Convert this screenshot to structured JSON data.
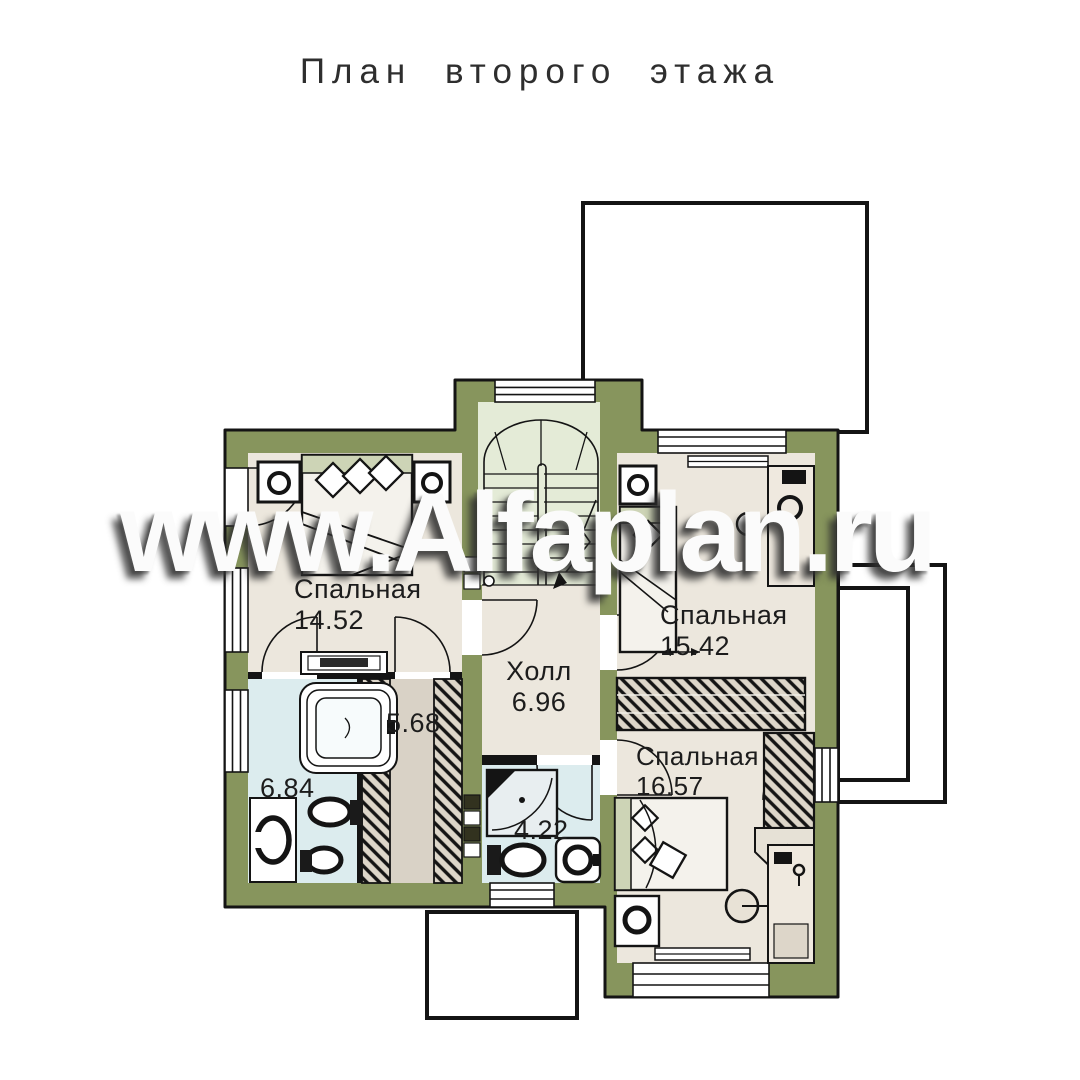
{
  "title": "План второго этажа",
  "watermark": "www.Alfaplan.ru",
  "rooms": {
    "bedroom1": {
      "name": "Спальная",
      "area": "14.52"
    },
    "bedroom2": {
      "name": "Спальная",
      "area": "15.42"
    },
    "bedroom3": {
      "name": "Спальная",
      "area": "16.57"
    },
    "hall": {
      "name": "Холл",
      "area": "6.96"
    },
    "bathroom_main": {
      "area": "6.84"
    },
    "dressing": {
      "area": "5.68"
    },
    "bathroom_small": {
      "area": "4.22"
    }
  },
  "colors": {
    "wall": "#87955d",
    "room_floor": "#ece7dd",
    "bathroom_floor": "#dcecee",
    "stair_floor": "#e4ebd7",
    "wardrobe_fill": "#ddd6c9",
    "outline": "#141414",
    "background": "#ffffff"
  }
}
